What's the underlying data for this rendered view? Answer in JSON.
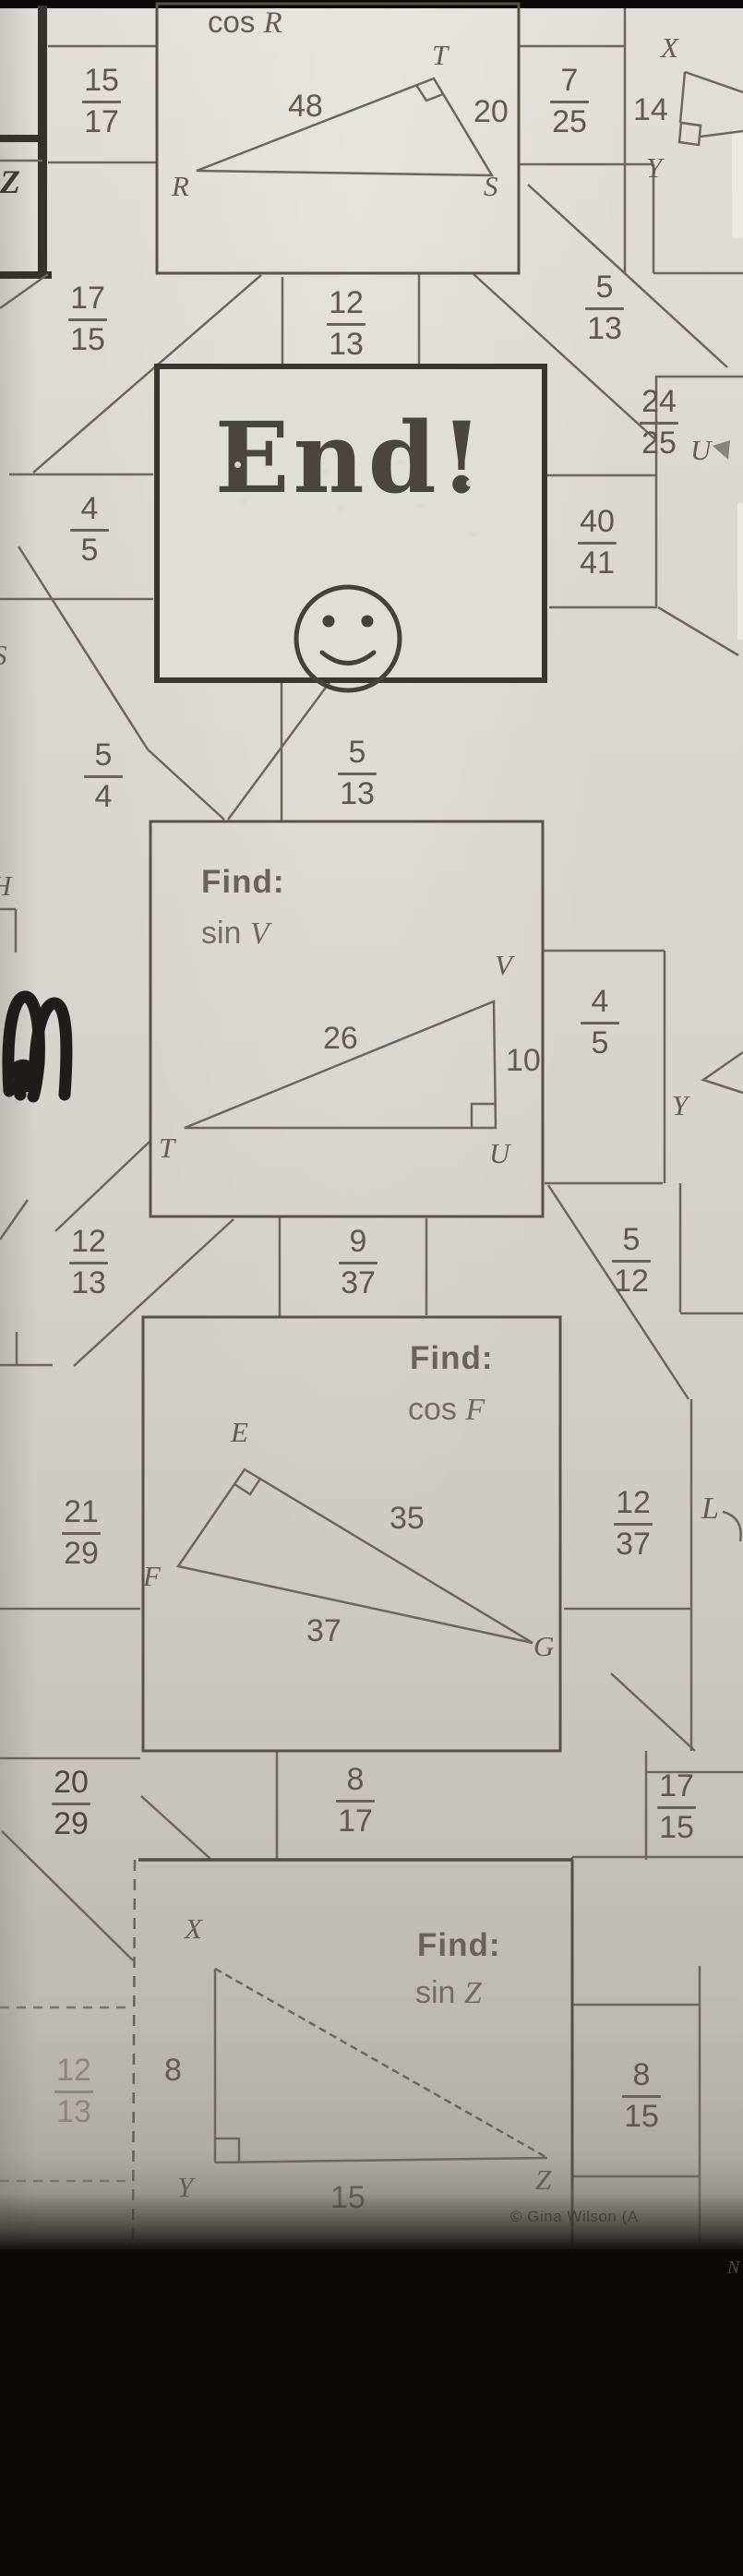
{
  "colors": {
    "paper": "#d8d5ce",
    "maze_line": "#6b675f",
    "problem_box_border": "#57534b",
    "end_box_border": "#3a3733",
    "ink": "#5d5952",
    "scribble": "#1f1d1b"
  },
  "problems": {
    "cos_r": {
      "fn": "cos",
      "angle": "R",
      "hyp": "48",
      "leg": "20",
      "vertex_r": "R",
      "vertex_t": "T",
      "vertex_s": "S"
    },
    "sin_v": {
      "find": "Find:",
      "fn": "sin",
      "angle": "V",
      "hyp": "26",
      "leg": "10",
      "vertex_t": "T",
      "vertex_u": "U",
      "vertex_v": "V"
    },
    "cos_f": {
      "find": "Find:",
      "fn": "cos",
      "angle": "F",
      "hyp": "35",
      "base": "37",
      "vertex_e": "E",
      "vertex_f": "F",
      "vertex_g": "G"
    },
    "sin_z": {
      "find": "Find:",
      "fn": "sin",
      "angle": "Z",
      "leg": "8",
      "base": "15",
      "vertex_x": "X",
      "vertex_y": "Y",
      "vertex_z": "Z"
    }
  },
  "end_box": {
    "text": "End!"
  },
  "answers": {
    "f15_17": {
      "n": "15",
      "d": "17"
    },
    "f7_25": {
      "n": "7",
      "d": "25"
    },
    "n14": "14",
    "f17_15a": {
      "n": "17",
      "d": "15"
    },
    "f12_13a": {
      "n": "12",
      "d": "13"
    },
    "f5_13a": {
      "n": "5",
      "d": "13"
    },
    "f24_25": {
      "n": "24",
      "d": "25"
    },
    "f40_41": {
      "n": "40",
      "d": "41"
    },
    "f4_5a": {
      "n": "4",
      "d": "5"
    },
    "f5_4": {
      "n": "5",
      "d": "4"
    },
    "f5_13b": {
      "n": "5",
      "d": "13"
    },
    "f4_5b": {
      "n": "4",
      "d": "5"
    },
    "f12_13b": {
      "n": "12",
      "d": "13"
    },
    "f9_37": {
      "n": "9",
      "d": "37"
    },
    "f5_12": {
      "n": "5",
      "d": "12"
    },
    "f21_29": {
      "n": "21",
      "d": "29"
    },
    "f12_37": {
      "n": "12",
      "d": "37"
    },
    "f20_29": {
      "n": "20",
      "d": "29"
    },
    "f8_17": {
      "n": "8",
      "d": "17"
    },
    "f17_15b": {
      "n": "17",
      "d": "15"
    },
    "f12_13c": {
      "n": "12",
      "d": "13"
    },
    "f8_15": {
      "n": "8",
      "d": "15"
    }
  },
  "letters": {
    "z_edge": "Z",
    "x_top": "X",
    "y_top": "Y",
    "u_mid": "U",
    "y_mid": "Y",
    "l_mid": "L",
    "s_edge": "S",
    "h_edge": "H",
    "n_bottom": "N"
  },
  "footer": {
    "credit": "© Gina Wilson (A"
  }
}
